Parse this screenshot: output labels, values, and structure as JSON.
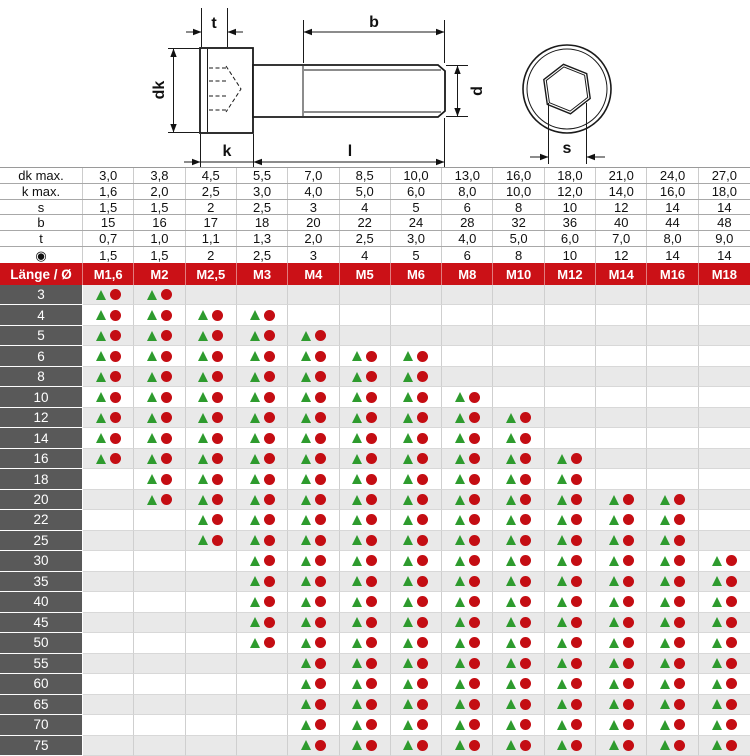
{
  "colors": {
    "header_red": "#cb1117",
    "label_gray": "#595959",
    "row_alt_gray": "#e9e9e9",
    "triangle_green": "#2e9b2e",
    "circle_dark_red": "#c40d13"
  },
  "drawing": {
    "labels": {
      "t": "t",
      "b": "b",
      "dk": "dk",
      "d": "d",
      "k": "k",
      "l": "l",
      "s": "s"
    }
  },
  "dimension_table": {
    "rows": [
      {
        "label": "dk max.",
        "values": [
          "3,0",
          "3,8",
          "4,5",
          "5,5",
          "7,0",
          "8,5",
          "10,0",
          "13,0",
          "16,0",
          "18,0",
          "21,0",
          "24,0",
          "27,0"
        ]
      },
      {
        "label": "k max.",
        "values": [
          "1,6",
          "2,0",
          "2,5",
          "3,0",
          "4,0",
          "5,0",
          "6,0",
          "8,0",
          "10,0",
          "12,0",
          "14,0",
          "16,0",
          "18,0"
        ]
      },
      {
        "label": "s",
        "values": [
          "1,5",
          "1,5",
          "2",
          "2,5",
          "3",
          "4",
          "5",
          "6",
          "8",
          "10",
          "12",
          "14",
          "14"
        ]
      },
      {
        "label": "b",
        "values": [
          "15",
          "16",
          "17",
          "18",
          "20",
          "22",
          "24",
          "28",
          "32",
          "36",
          "40",
          "44",
          "48"
        ]
      },
      {
        "label": "t",
        "values": [
          "0,7",
          "1,0",
          "1,1",
          "1,3",
          "2,0",
          "2,5",
          "3,0",
          "4,0",
          "5,0",
          "6,0",
          "7,0",
          "8,0",
          "9,0"
        ]
      },
      {
        "label": "◉",
        "values": [
          "1,5",
          "1,5",
          "2",
          "2,5",
          "3",
          "4",
          "5",
          "6",
          "8",
          "10",
          "12",
          "14",
          "14"
        ]
      }
    ]
  },
  "matrix": {
    "corner_label": "Länge / Ø",
    "columns": [
      "M1,6",
      "M2",
      "M2,5",
      "M3",
      "M4",
      "M5",
      "M6",
      "M8",
      "M10",
      "M12",
      "M14",
      "M16",
      "M18"
    ],
    "symbols": {
      "triangle": "triangle-green",
      "circle": "circle-dark-red"
    },
    "rows": [
      {
        "length": "3",
        "available": [
          1,
          1,
          0,
          0,
          0,
          0,
          0,
          0,
          0,
          0,
          0,
          0,
          0
        ]
      },
      {
        "length": "4",
        "available": [
          1,
          1,
          1,
          1,
          0,
          0,
          0,
          0,
          0,
          0,
          0,
          0,
          0
        ]
      },
      {
        "length": "5",
        "available": [
          1,
          1,
          1,
          1,
          1,
          0,
          0,
          0,
          0,
          0,
          0,
          0,
          0
        ]
      },
      {
        "length": "6",
        "available": [
          1,
          1,
          1,
          1,
          1,
          1,
          1,
          0,
          0,
          0,
          0,
          0,
          0
        ]
      },
      {
        "length": "8",
        "available": [
          1,
          1,
          1,
          1,
          1,
          1,
          1,
          0,
          0,
          0,
          0,
          0,
          0
        ]
      },
      {
        "length": "10",
        "available": [
          1,
          1,
          1,
          1,
          1,
          1,
          1,
          1,
          0,
          0,
          0,
          0,
          0
        ]
      },
      {
        "length": "12",
        "available": [
          1,
          1,
          1,
          1,
          1,
          1,
          1,
          1,
          1,
          0,
          0,
          0,
          0
        ]
      },
      {
        "length": "14",
        "available": [
          1,
          1,
          1,
          1,
          1,
          1,
          1,
          1,
          1,
          0,
          0,
          0,
          0
        ]
      },
      {
        "length": "16",
        "available": [
          1,
          1,
          1,
          1,
          1,
          1,
          1,
          1,
          1,
          1,
          0,
          0,
          0
        ]
      },
      {
        "length": "18",
        "available": [
          0,
          1,
          1,
          1,
          1,
          1,
          1,
          1,
          1,
          1,
          0,
          0,
          0
        ]
      },
      {
        "length": "20",
        "available": [
          0,
          1,
          1,
          1,
          1,
          1,
          1,
          1,
          1,
          1,
          1,
          1,
          0
        ]
      },
      {
        "length": "22",
        "available": [
          0,
          0,
          1,
          1,
          1,
          1,
          1,
          1,
          1,
          1,
          1,
          1,
          0
        ]
      },
      {
        "length": "25",
        "available": [
          0,
          0,
          1,
          1,
          1,
          1,
          1,
          1,
          1,
          1,
          1,
          1,
          0
        ]
      },
      {
        "length": "30",
        "available": [
          0,
          0,
          0,
          1,
          1,
          1,
          1,
          1,
          1,
          1,
          1,
          1,
          1
        ]
      },
      {
        "length": "35",
        "available": [
          0,
          0,
          0,
          1,
          1,
          1,
          1,
          1,
          1,
          1,
          1,
          1,
          1
        ]
      },
      {
        "length": "40",
        "available": [
          0,
          0,
          0,
          1,
          1,
          1,
          1,
          1,
          1,
          1,
          1,
          1,
          1
        ]
      },
      {
        "length": "45",
        "available": [
          0,
          0,
          0,
          1,
          1,
          1,
          1,
          1,
          1,
          1,
          1,
          1,
          1
        ]
      },
      {
        "length": "50",
        "available": [
          0,
          0,
          0,
          1,
          1,
          1,
          1,
          1,
          1,
          1,
          1,
          1,
          1
        ]
      },
      {
        "length": "55",
        "available": [
          0,
          0,
          0,
          0,
          1,
          1,
          1,
          1,
          1,
          1,
          1,
          1,
          1
        ]
      },
      {
        "length": "60",
        "available": [
          0,
          0,
          0,
          0,
          1,
          1,
          1,
          1,
          1,
          1,
          1,
          1,
          1
        ]
      },
      {
        "length": "65",
        "available": [
          0,
          0,
          0,
          0,
          1,
          1,
          1,
          1,
          1,
          1,
          1,
          1,
          1
        ]
      },
      {
        "length": "70",
        "available": [
          0,
          0,
          0,
          0,
          1,
          1,
          1,
          1,
          1,
          1,
          1,
          1,
          1
        ]
      },
      {
        "length": "75",
        "available": [
          0,
          0,
          0,
          0,
          1,
          1,
          1,
          1,
          1,
          1,
          1,
          1,
          1
        ]
      }
    ]
  }
}
